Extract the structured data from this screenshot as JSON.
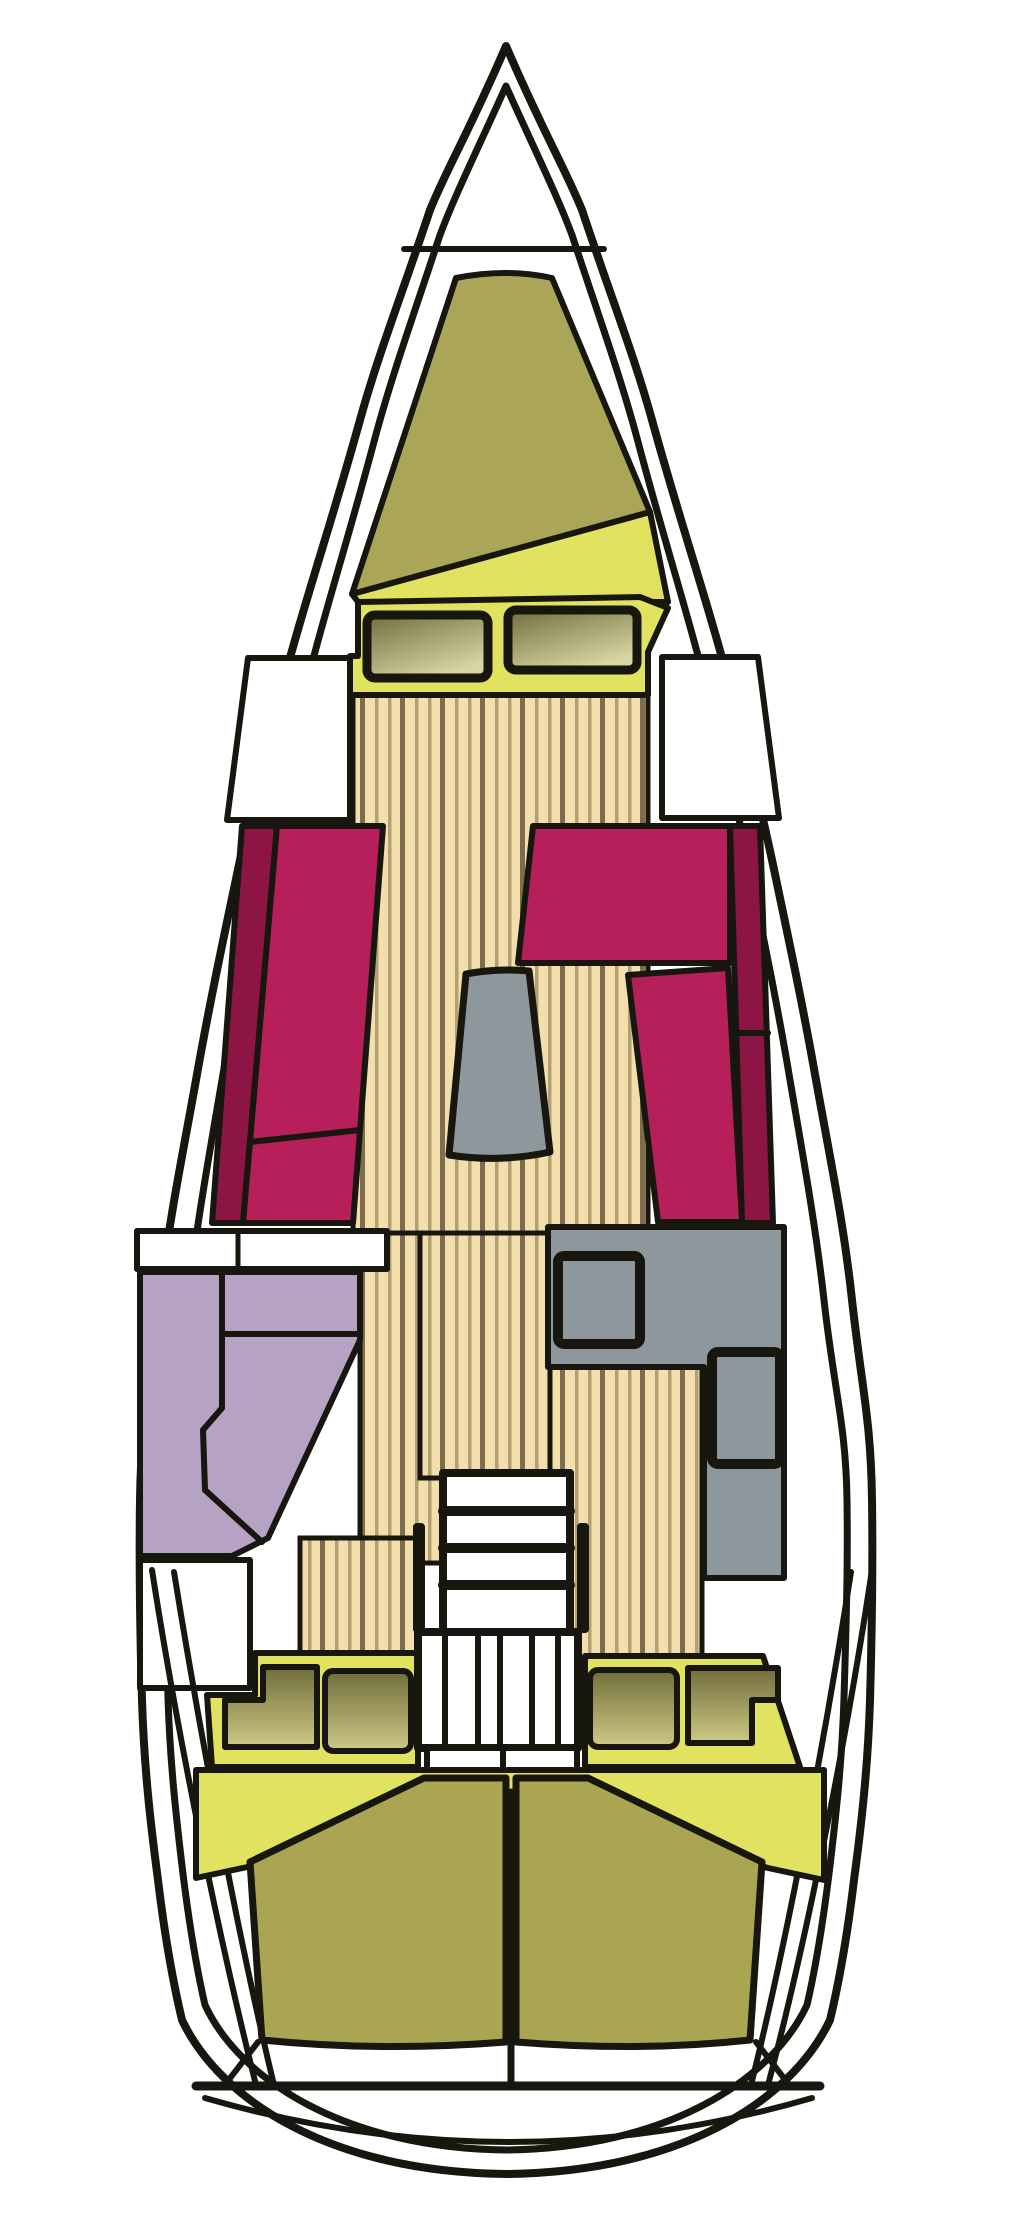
{
  "diagram": {
    "type": "boat-floorplan",
    "description_visible_text": "",
    "palette": {
      "line": "#17170f",
      "hull_fill": "#ffffff",
      "crimson": "#b71f5b",
      "crimsonDark": "#8c1544",
      "olive": "#aba657",
      "oliveAft": "#aaa553",
      "yellow": "#e1e260",
      "wood": "#f3dfab",
      "woodLine": "#b39f74",
      "woodDark": "#7d6c4d",
      "gray": "#8e989c",
      "lavender": "#b6a2c3",
      "windowDark": "#6f6d3c",
      "windowLight": "#d8d6a2",
      "cushionDark": "#716d3b",
      "cushionLight": "#cdc985"
    },
    "regions": [
      {
        "id": "hull-outline",
        "kind": "structure"
      },
      {
        "id": "forepeak-locker",
        "kind": "storage"
      },
      {
        "id": "v-berth-bow-cabin",
        "kind": "cabin"
      },
      {
        "id": "deck-hatch-port",
        "kind": "hatch"
      },
      {
        "id": "deck-hatch-starboard",
        "kind": "hatch"
      },
      {
        "id": "locker-port",
        "kind": "storage"
      },
      {
        "id": "locker-starboard",
        "kind": "storage"
      },
      {
        "id": "salon-settee-port",
        "kind": "seating"
      },
      {
        "id": "salon-settee-starboard",
        "kind": "seating"
      },
      {
        "id": "salon-table",
        "kind": "table"
      },
      {
        "id": "head-compartment",
        "kind": "bathroom"
      },
      {
        "id": "galley",
        "kind": "kitchen"
      },
      {
        "id": "companionway-stairs",
        "kind": "stairs"
      },
      {
        "id": "aft-seat-port",
        "kind": "seating"
      },
      {
        "id": "aft-seat-starboard",
        "kind": "seating"
      },
      {
        "id": "aft-berth-port",
        "kind": "cabin"
      },
      {
        "id": "aft-berth-starboard",
        "kind": "cabin"
      },
      {
        "id": "transom",
        "kind": "structure"
      }
    ]
  }
}
